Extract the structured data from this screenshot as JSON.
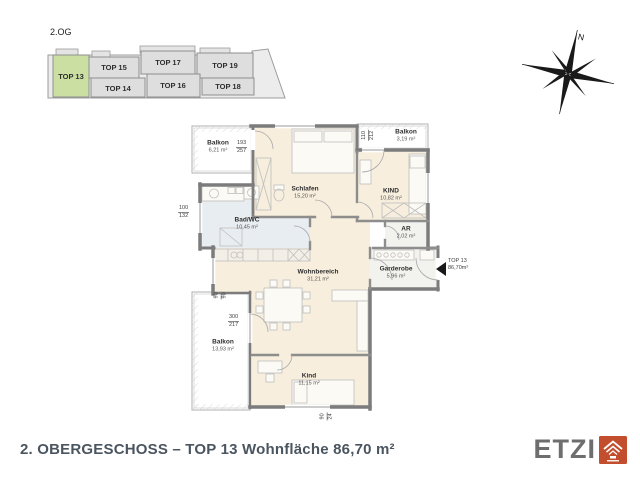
{
  "overview": {
    "floor_label": "2.OG",
    "units": [
      {
        "label": "TOP 13",
        "highlighted": true
      },
      {
        "label": "TOP 15",
        "highlighted": false
      },
      {
        "label": "TOP 17",
        "highlighted": false
      },
      {
        "label": "TOP 19",
        "highlighted": false
      },
      {
        "label": "TOP 14",
        "highlighted": false
      },
      {
        "label": "TOP 16",
        "highlighted": false
      },
      {
        "label": "TOP 18",
        "highlighted": false
      }
    ]
  },
  "compass": {
    "north_label": "N"
  },
  "plan": {
    "rooms": [
      {
        "name": "Balkon",
        "area": "6,21 m²"
      },
      {
        "name": "Schlafen",
        "area": "15,20 m²"
      },
      {
        "name": "Balkon",
        "area": "3,19 m²"
      },
      {
        "name": "KIND",
        "area": "10,82 m²"
      },
      {
        "name": "Bad/WC",
        "area": "10,45 m²"
      },
      {
        "name": "AR",
        "area": "2,02 m²"
      },
      {
        "name": "Wohnbereich",
        "area": "31,21 m²"
      },
      {
        "name": "Garderobe",
        "area": "5,96 m²"
      },
      {
        "name": "Balkon",
        "area": "13,93 m²"
      },
      {
        "name": "Kind",
        "area": "11,15 m²"
      }
    ],
    "entrance": {
      "unit": "TOP 13",
      "area": "86,70m²"
    },
    "dimensions": [
      {
        "top": "193",
        "bottom": "257"
      },
      {
        "top": "110",
        "bottom": "212"
      },
      {
        "top": "100",
        "bottom": "132"
      },
      {
        "top": "300",
        "bottom": "217"
      },
      {
        "top": "90",
        "bottom": "90"
      },
      {
        "top": "90",
        "bottom": "24"
      }
    ]
  },
  "footer": {
    "title": "2. OBERGESCHOSS – TOP 13 Wohnfläche 86,70 m²"
  },
  "logo": {
    "name": "ETZI"
  },
  "colors": {
    "highlight_green": "#cbdfa3",
    "logo_red": "#c24e2d",
    "title_text": "#4b5560",
    "room_beige": "#f7eedd",
    "bath_blue": "#e8edf1"
  }
}
